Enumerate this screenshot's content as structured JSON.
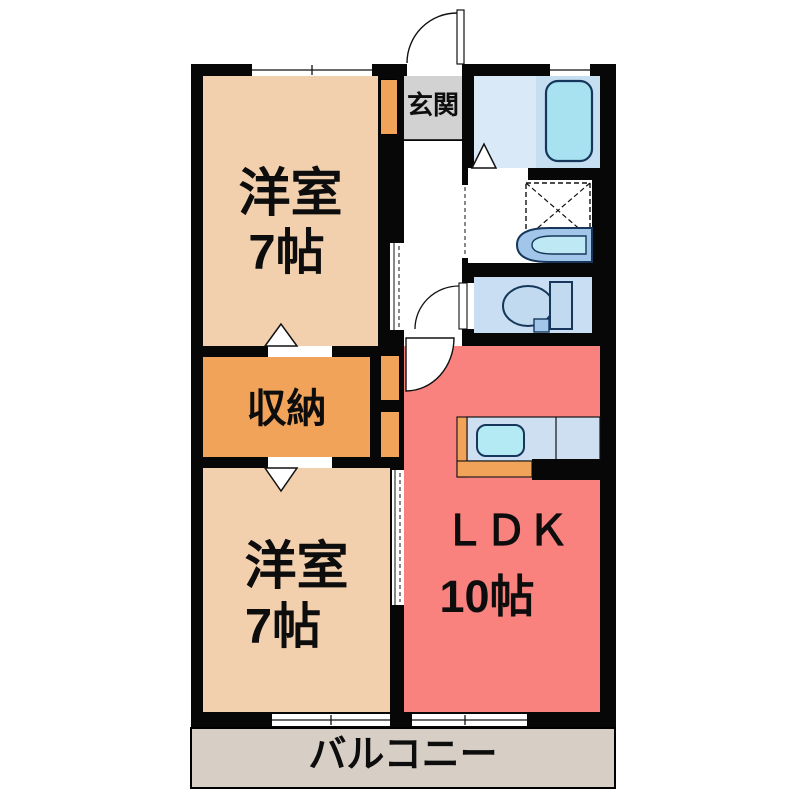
{
  "floorplan": {
    "rooms": {
      "bedroom_top": {
        "label": "洋室",
        "area": "7帖"
      },
      "bedroom_bottom": {
        "label": "洋室",
        "area": "7帖"
      },
      "ldk": {
        "label": "ＬＤＫ",
        "area": "10帖"
      },
      "storage": {
        "label": "収納"
      },
      "entrance": {
        "label": "玄関"
      },
      "balcony": {
        "label": "バルコニー"
      }
    },
    "fixtures": [
      "bathtub-icon",
      "washing-machine-pan-icon",
      "washbasin-icon",
      "toilet-icon",
      "kitchen-sink-icon",
      "hinged-door-arc-icon",
      "sliding-door-icon",
      "opening-direction-triangle-icon",
      "sliding-window-icon"
    ],
    "colors": {
      "wall": "#070707",
      "bedroom_peach": "#F2D0AE",
      "storage_orange": "#F0A359",
      "ldk_pink": "#F9827E",
      "entrance_gray": "#D2D2D2",
      "balcony_gray": "#D7CFC5",
      "bath_floor_blue": "#D9E9F8",
      "tub_surround_blue": "#C5DEF0",
      "toilet_floor_blue": "#C9DEF3",
      "fixture_blue": "#A8E2F0",
      "counter_blue": "#CEDFF2",
      "fixture_outline": "#16375B"
    }
  }
}
